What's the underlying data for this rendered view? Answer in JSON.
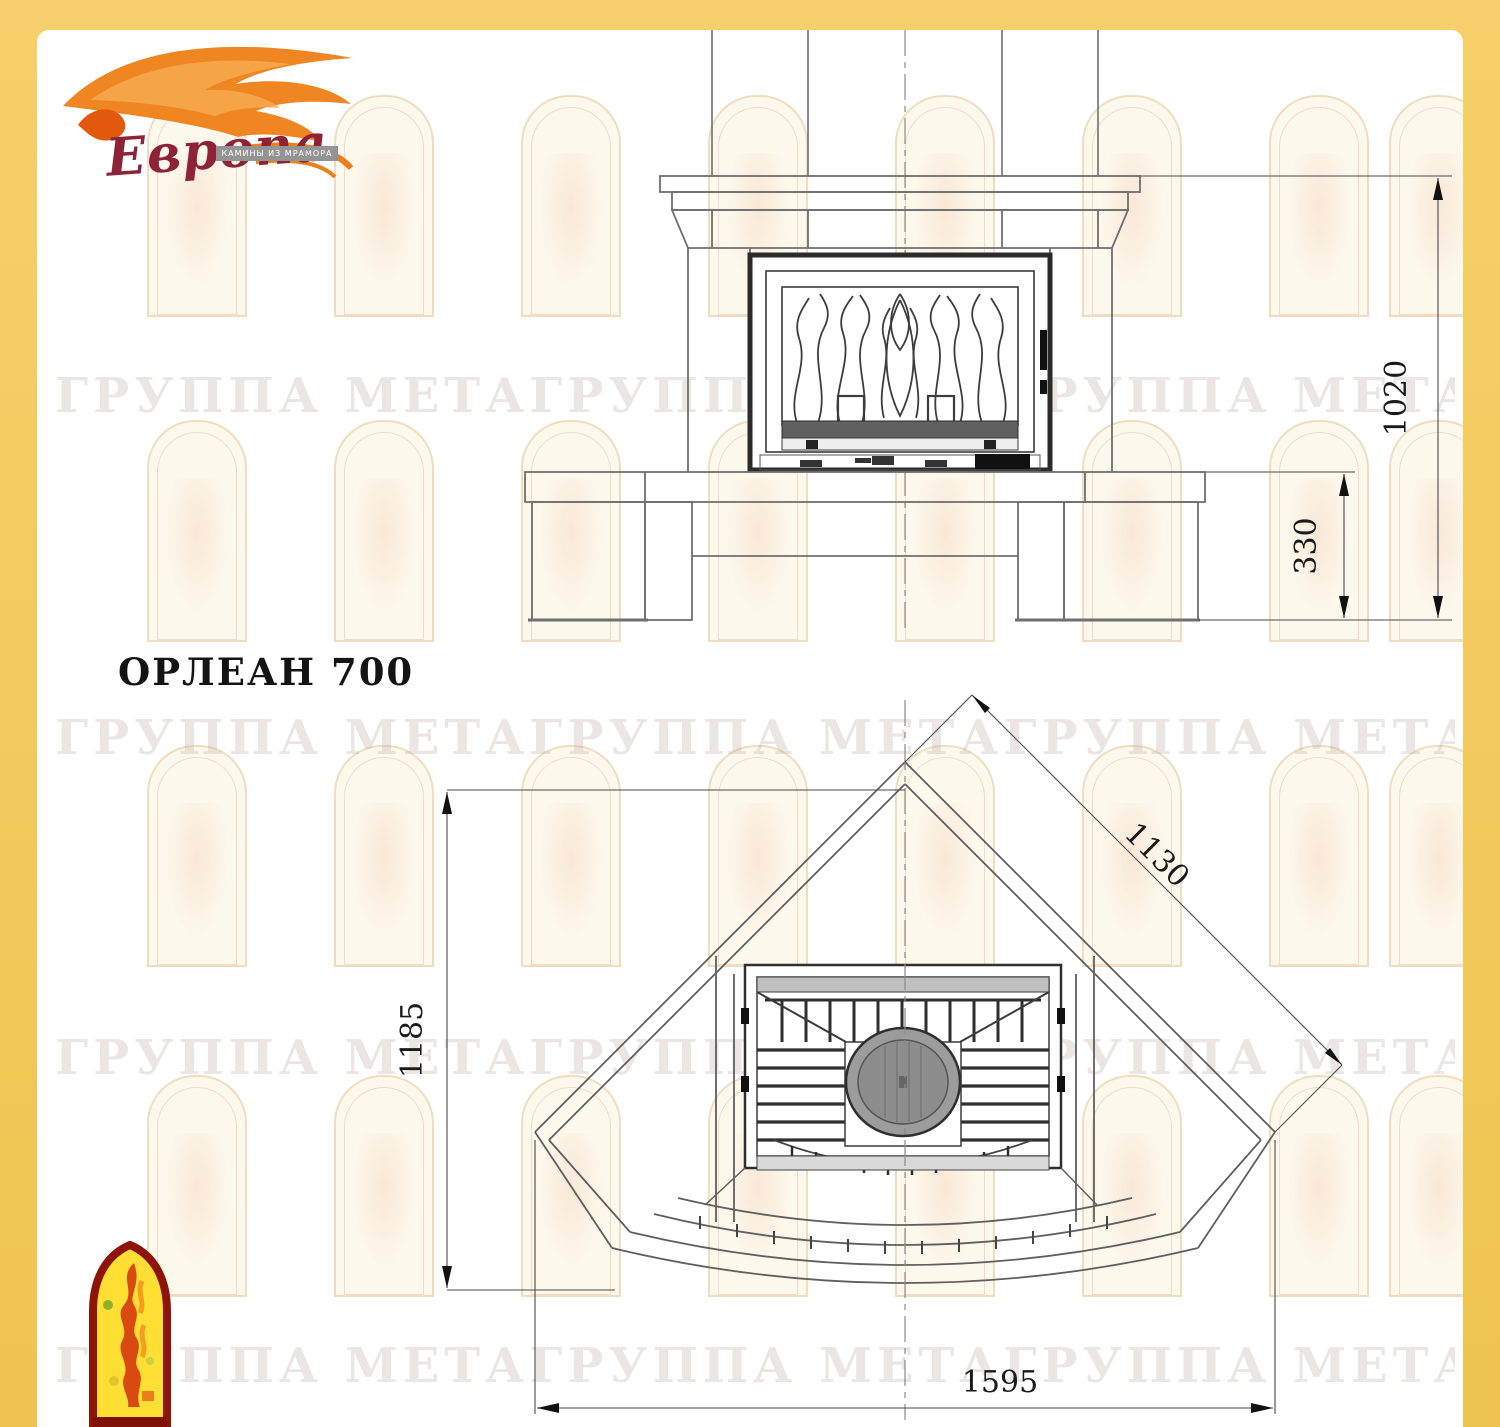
{
  "page": {
    "border_color": "#F2C95C",
    "paper_color": "#FFFFFF"
  },
  "logo": {
    "brand": "Европа",
    "tagline": "КАМИНЫ ИЗ МРАМОРА",
    "flame_color": "#EE7F16",
    "brand_color": "#8E2237"
  },
  "watermark": {
    "text": "ГРУППА МЕТАГРУППА МЕТАГРУППА МЕТАГРУППА МЕТА"
  },
  "model": {
    "title": "ОРЛЕАН 700"
  },
  "front_view": {
    "dims": {
      "total_height": "1020",
      "hearth_height": "330"
    }
  },
  "plan_view": {
    "dims": {
      "depth": "1185",
      "side_width": "1130",
      "overall_width": "1595"
    }
  }
}
